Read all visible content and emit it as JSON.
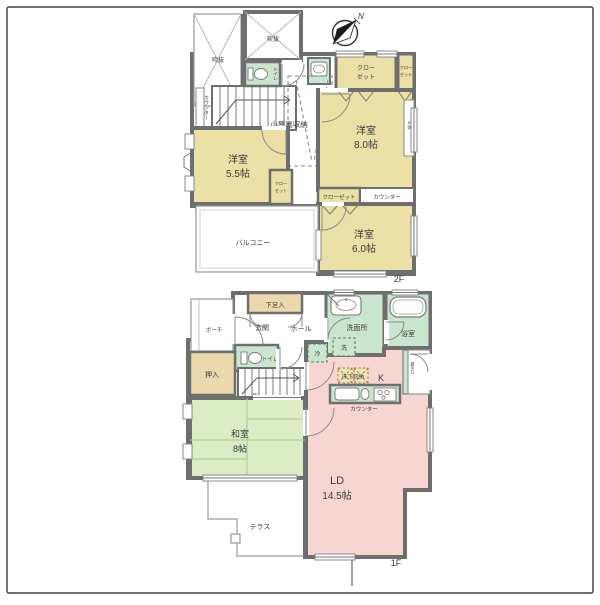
{
  "compass": {
    "north": "N"
  },
  "floor2": {
    "label": "2F",
    "rooms": {
      "void_left": {
        "name": "吹抜"
      },
      "void_center": {
        "name": "吹抜"
      },
      "toilet": {
        "name": "トイレ"
      },
      "attic_storage": {
        "name": "小屋裏収納"
      },
      "closet_right_large": {
        "line1": "クロー",
        "line2": "ゼット"
      },
      "closet_right_small": {
        "line1": "クロー",
        "line2": "ゼット"
      },
      "closet_mid": {
        "line1": "クロー",
        "line2": "ゼット"
      },
      "closet_strip": {
        "name": "クローゼット"
      },
      "counter_stair": {
        "name": "カウンター"
      },
      "counter_strip": {
        "name": "カウンター"
      },
      "shutter_box": {
        "name": "戸袋"
      },
      "yoshitsu8": {
        "name": "洋室",
        "size": "8.0帖"
      },
      "yoshitsu55": {
        "name": "洋室",
        "size": "5.5帖"
      },
      "yoshitsu6": {
        "name": "洋室",
        "size": "6.0帖"
      },
      "balcony": {
        "name": "バルコニー"
      }
    }
  },
  "floor1": {
    "label": "1F",
    "rooms": {
      "getabako": {
        "name": "下足入"
      },
      "porch": {
        "name": "ポーチ"
      },
      "genkan": {
        "name": "玄関"
      },
      "hall": {
        "name": "ホール"
      },
      "senmenjo": {
        "name": "洗面所"
      },
      "bathroom": {
        "name": "浴室"
      },
      "toilet": {
        "name": "トイレ"
      },
      "oshiire": {
        "name": "押入"
      },
      "understair_storage": {
        "name": "物入"
      },
      "refrigerator": {
        "name": "冷"
      },
      "washer": {
        "name": "洗"
      },
      "underfloor_storage": {
        "name": "床下収納"
      },
      "kitchen": {
        "name": "K"
      },
      "counter": {
        "name": "カウンター"
      },
      "katteguchi": {
        "name": "勝手口"
      },
      "washitsu": {
        "name": "和室",
        "size": "8帖"
      },
      "ld": {
        "name": "LD",
        "size": "14.5帖"
      },
      "terrace": {
        "name": "テラス"
      }
    }
  },
  "colors": {
    "wall": "#6E6E6E",
    "western_room_tan": "#EBE0A5",
    "storage_beige": "#EDD9AE",
    "wet_area_green": "#CBE6CF",
    "tatami_green": "#DCEDC6",
    "living_pink": "#F8D7D3",
    "underfloor_tan": "#F0E4B8"
  }
}
